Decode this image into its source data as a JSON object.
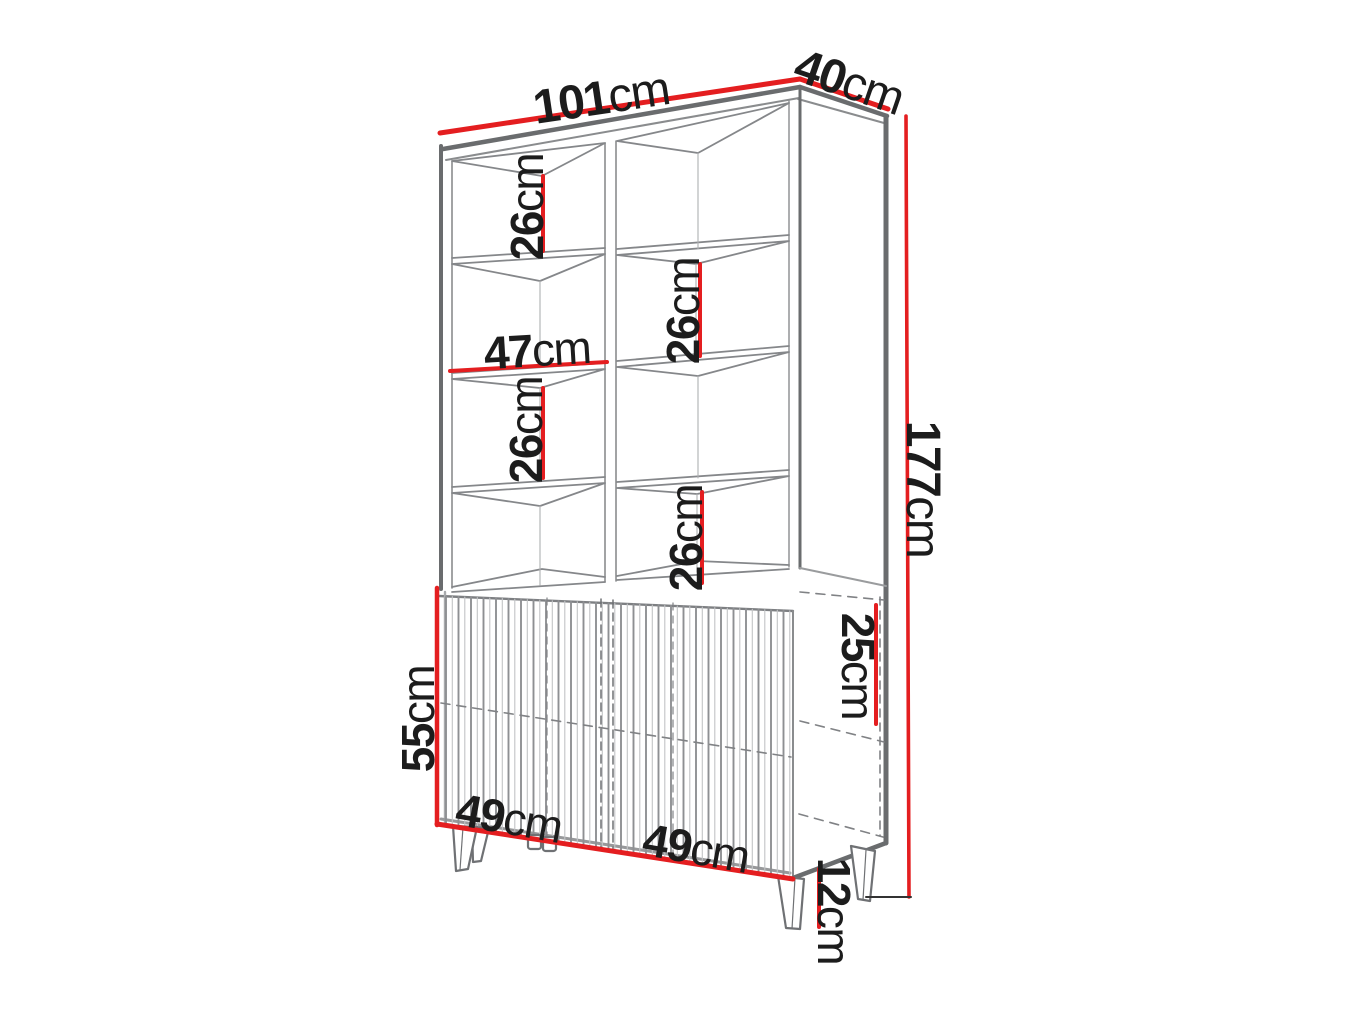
{
  "diagram": {
    "type": "furniture-dimension-drawing",
    "subject": "tall display cabinet with two columns of open shelves, fluted two-door base cabinet and angled legs"
  },
  "colors": {
    "dimension_line": "#e41e20",
    "outline_dark": "#6a6c6e",
    "outline_mid": "#8a8c8e",
    "outline_light": "#c2c4c6",
    "label_text": "#1c1c1c",
    "background": "#ffffff"
  },
  "dimensions": {
    "total_width": {
      "value": "101",
      "unit": "cm"
    },
    "total_depth": {
      "value": "40",
      "unit": "cm"
    },
    "total_height": {
      "value": "177",
      "unit": "cm"
    },
    "left_column_upper_shelf": {
      "value": "26",
      "unit": "cm"
    },
    "left_column_lower_shelf": {
      "value": "26",
      "unit": "cm"
    },
    "right_column_upper_shelf": {
      "value": "26",
      "unit": "cm"
    },
    "right_column_lower_shelf": {
      "value": "26",
      "unit": "cm"
    },
    "shelf_inner_width": {
      "value": "47",
      "unit": "cm"
    },
    "base_front_height": {
      "value": "55",
      "unit": "cm"
    },
    "left_door_width": {
      "value": "49",
      "unit": "cm"
    },
    "right_door_width": {
      "value": "49",
      "unit": "cm"
    },
    "base_inner_compartment": {
      "value": "25",
      "unit": "cm"
    },
    "leg_height": {
      "value": "12",
      "unit": "cm"
    }
  }
}
